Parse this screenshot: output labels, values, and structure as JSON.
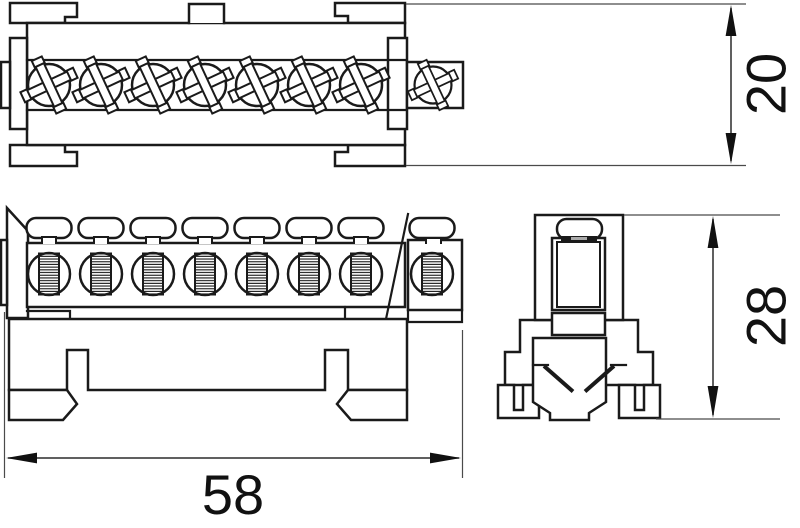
{
  "drawing": {
    "background": "#ffffff",
    "line_color": "#1a1a1a",
    "dim_line_color": "#3d3d3d",
    "text_color": "#111111",
    "views": {
      "top_view": {
        "phillips_screws": 7,
        "side_phillips_screws": 1
      },
      "front_view": {
        "wire_entry_slots": 8,
        "threaded_terminal_ports": 8
      },
      "side_view": {
        "clamp_screws": 1
      }
    },
    "dimensions": {
      "height": {
        "label": "20"
      },
      "depth": {
        "label": "28"
      },
      "width": {
        "label": "58"
      }
    }
  }
}
